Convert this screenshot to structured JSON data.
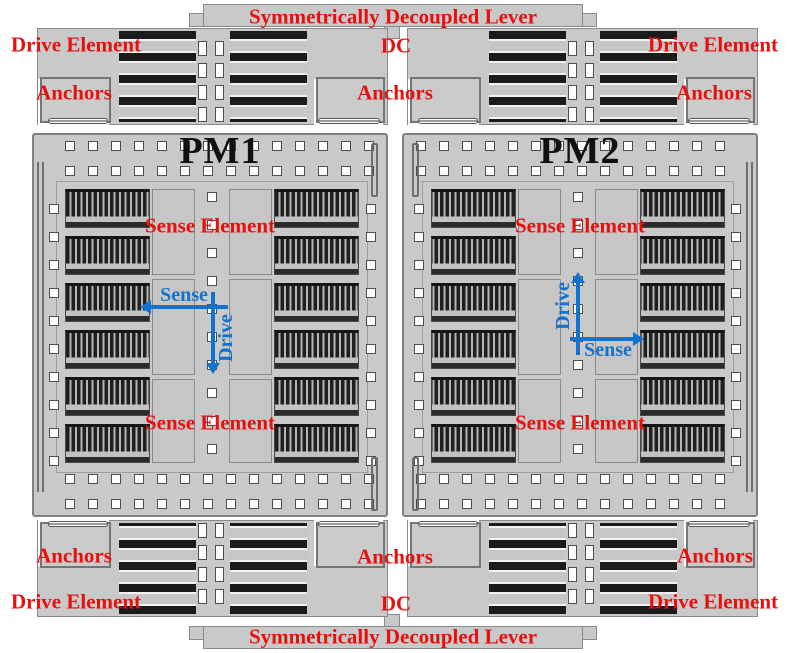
{
  "diagram": {
    "lever_top": "Symmetrically Decoupled Lever",
    "lever_bottom": "Symmetrically Decoupled Lever",
    "dc_top": "DC",
    "dc_bottom": "DC",
    "drive_element": {
      "top_left": "Drive Element",
      "top_right": "Drive Element",
      "bottom_left": "Drive Element",
      "bottom_right": "Drive Element"
    },
    "anchors": {
      "top_left": "Anchors",
      "top_center": "Anchors",
      "top_right": "Anchors",
      "bottom_left": "Anchors",
      "bottom_center": "Anchors",
      "bottom_right": "Anchors"
    },
    "modules": [
      {
        "name": "PM1",
        "sense_element_top": "Sense Element",
        "sense_element_bottom": "Sense Element",
        "arrow_horizontal": "Sense",
        "arrow_vertical": "Drive",
        "horizontal_direction": "left",
        "vertical_direction": "down"
      },
      {
        "name": "PM2",
        "sense_element_top": "Sense Element",
        "sense_element_bottom": "Sense Element",
        "arrow_horizontal": "Sense",
        "arrow_vertical": "Drive",
        "horizontal_direction": "right",
        "vertical_direction": "up"
      }
    ],
    "colors": {
      "label_red": "#e90f0f",
      "arrow_blue": "#1273cf",
      "body_gray": "#c9c9c9",
      "comb_dark": "#1d1d1d",
      "title_black": "#101010"
    }
  }
}
